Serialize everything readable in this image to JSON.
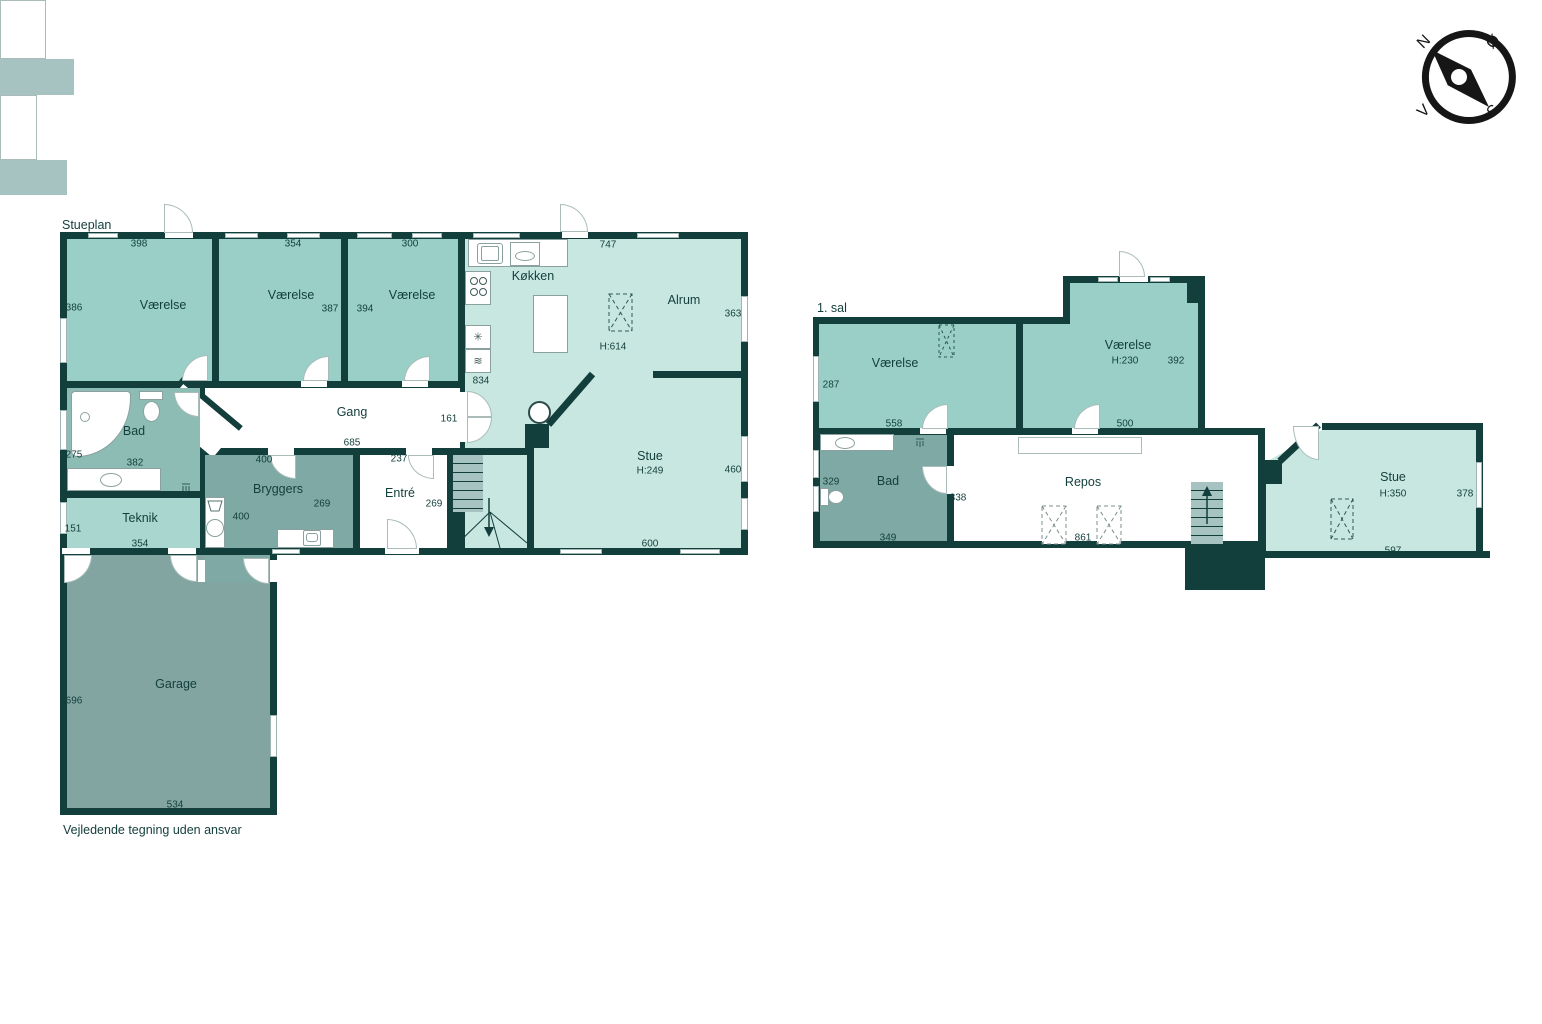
{
  "colors": {
    "wall": "#123e3b",
    "ink": "#123e3b",
    "teal": "#99cfc7",
    "mint": "#c9e7e1",
    "muted": "#8dbcb4",
    "teknik": "#a9d6cf",
    "utility": "#7fa9a4",
    "garage": "#83a5a2",
    "stairs": "#a6c2c1"
  },
  "footer": "Vejledende tegning uden ansvar",
  "compass": {
    "north": "N",
    "east": "Ø",
    "south": "S",
    "west": "V"
  },
  "icons": {
    "hotplate": "✳",
    "oven": "≋"
  },
  "stueplan": {
    "title": "Stueplan",
    "rooms": {
      "vaerelse1": {
        "label": "Værelse",
        "dim_top": "398",
        "dim_left": "386"
      },
      "vaerelse2": {
        "label": "Værelse",
        "dim_top": "354",
        "dim_right": "387"
      },
      "vaerelse3": {
        "label": "Værelse",
        "dim_top": "300",
        "dim_left": "394"
      },
      "koekken": {
        "label": "Køkken",
        "dim_top": "747",
        "dim_left": "834"
      },
      "alrum": {
        "label": "Alrum",
        "dim_right": "363",
        "height": "H:614"
      },
      "gang": {
        "label": "Gang",
        "dim_bottom": "685",
        "dim_right": "161"
      },
      "bad": {
        "label": "Bad",
        "dim_left": "275",
        "dim_top": "382"
      },
      "teknik": {
        "label": "Teknik",
        "dim_left": "151",
        "dim_bottom": "354"
      },
      "bryggers": {
        "label": "Bryggers",
        "dim_top": "400",
        "dim_right": "269",
        "dim_left": "400"
      },
      "entre": {
        "label": "Entré",
        "dim_top": "237",
        "dim_right": "269"
      },
      "stue": {
        "label": "Stue",
        "height": "H:249",
        "dim_right": "460",
        "dim_bottom": "600"
      },
      "garage": {
        "label": "Garage",
        "dim_left": "696",
        "dim_bottom": "534"
      }
    }
  },
  "first_floor": {
    "title": "1. sal",
    "rooms": {
      "vaerelse1": {
        "label": "Værelse",
        "dim_left": "287",
        "dim_bottom": "558"
      },
      "vaerelse2": {
        "label": "Værelse",
        "height": "H:230",
        "dim_right": "392",
        "dim_bottom": "500"
      },
      "bad": {
        "label": "Bad",
        "dim_left": "329",
        "dim_bottom": "349",
        "dim_right": "338"
      },
      "repos": {
        "label": "Repos",
        "dim_bottom": "861"
      },
      "stue": {
        "label": "Stue",
        "height": "H:350",
        "dim_right": "378",
        "dim_bottom": "597"
      }
    }
  }
}
